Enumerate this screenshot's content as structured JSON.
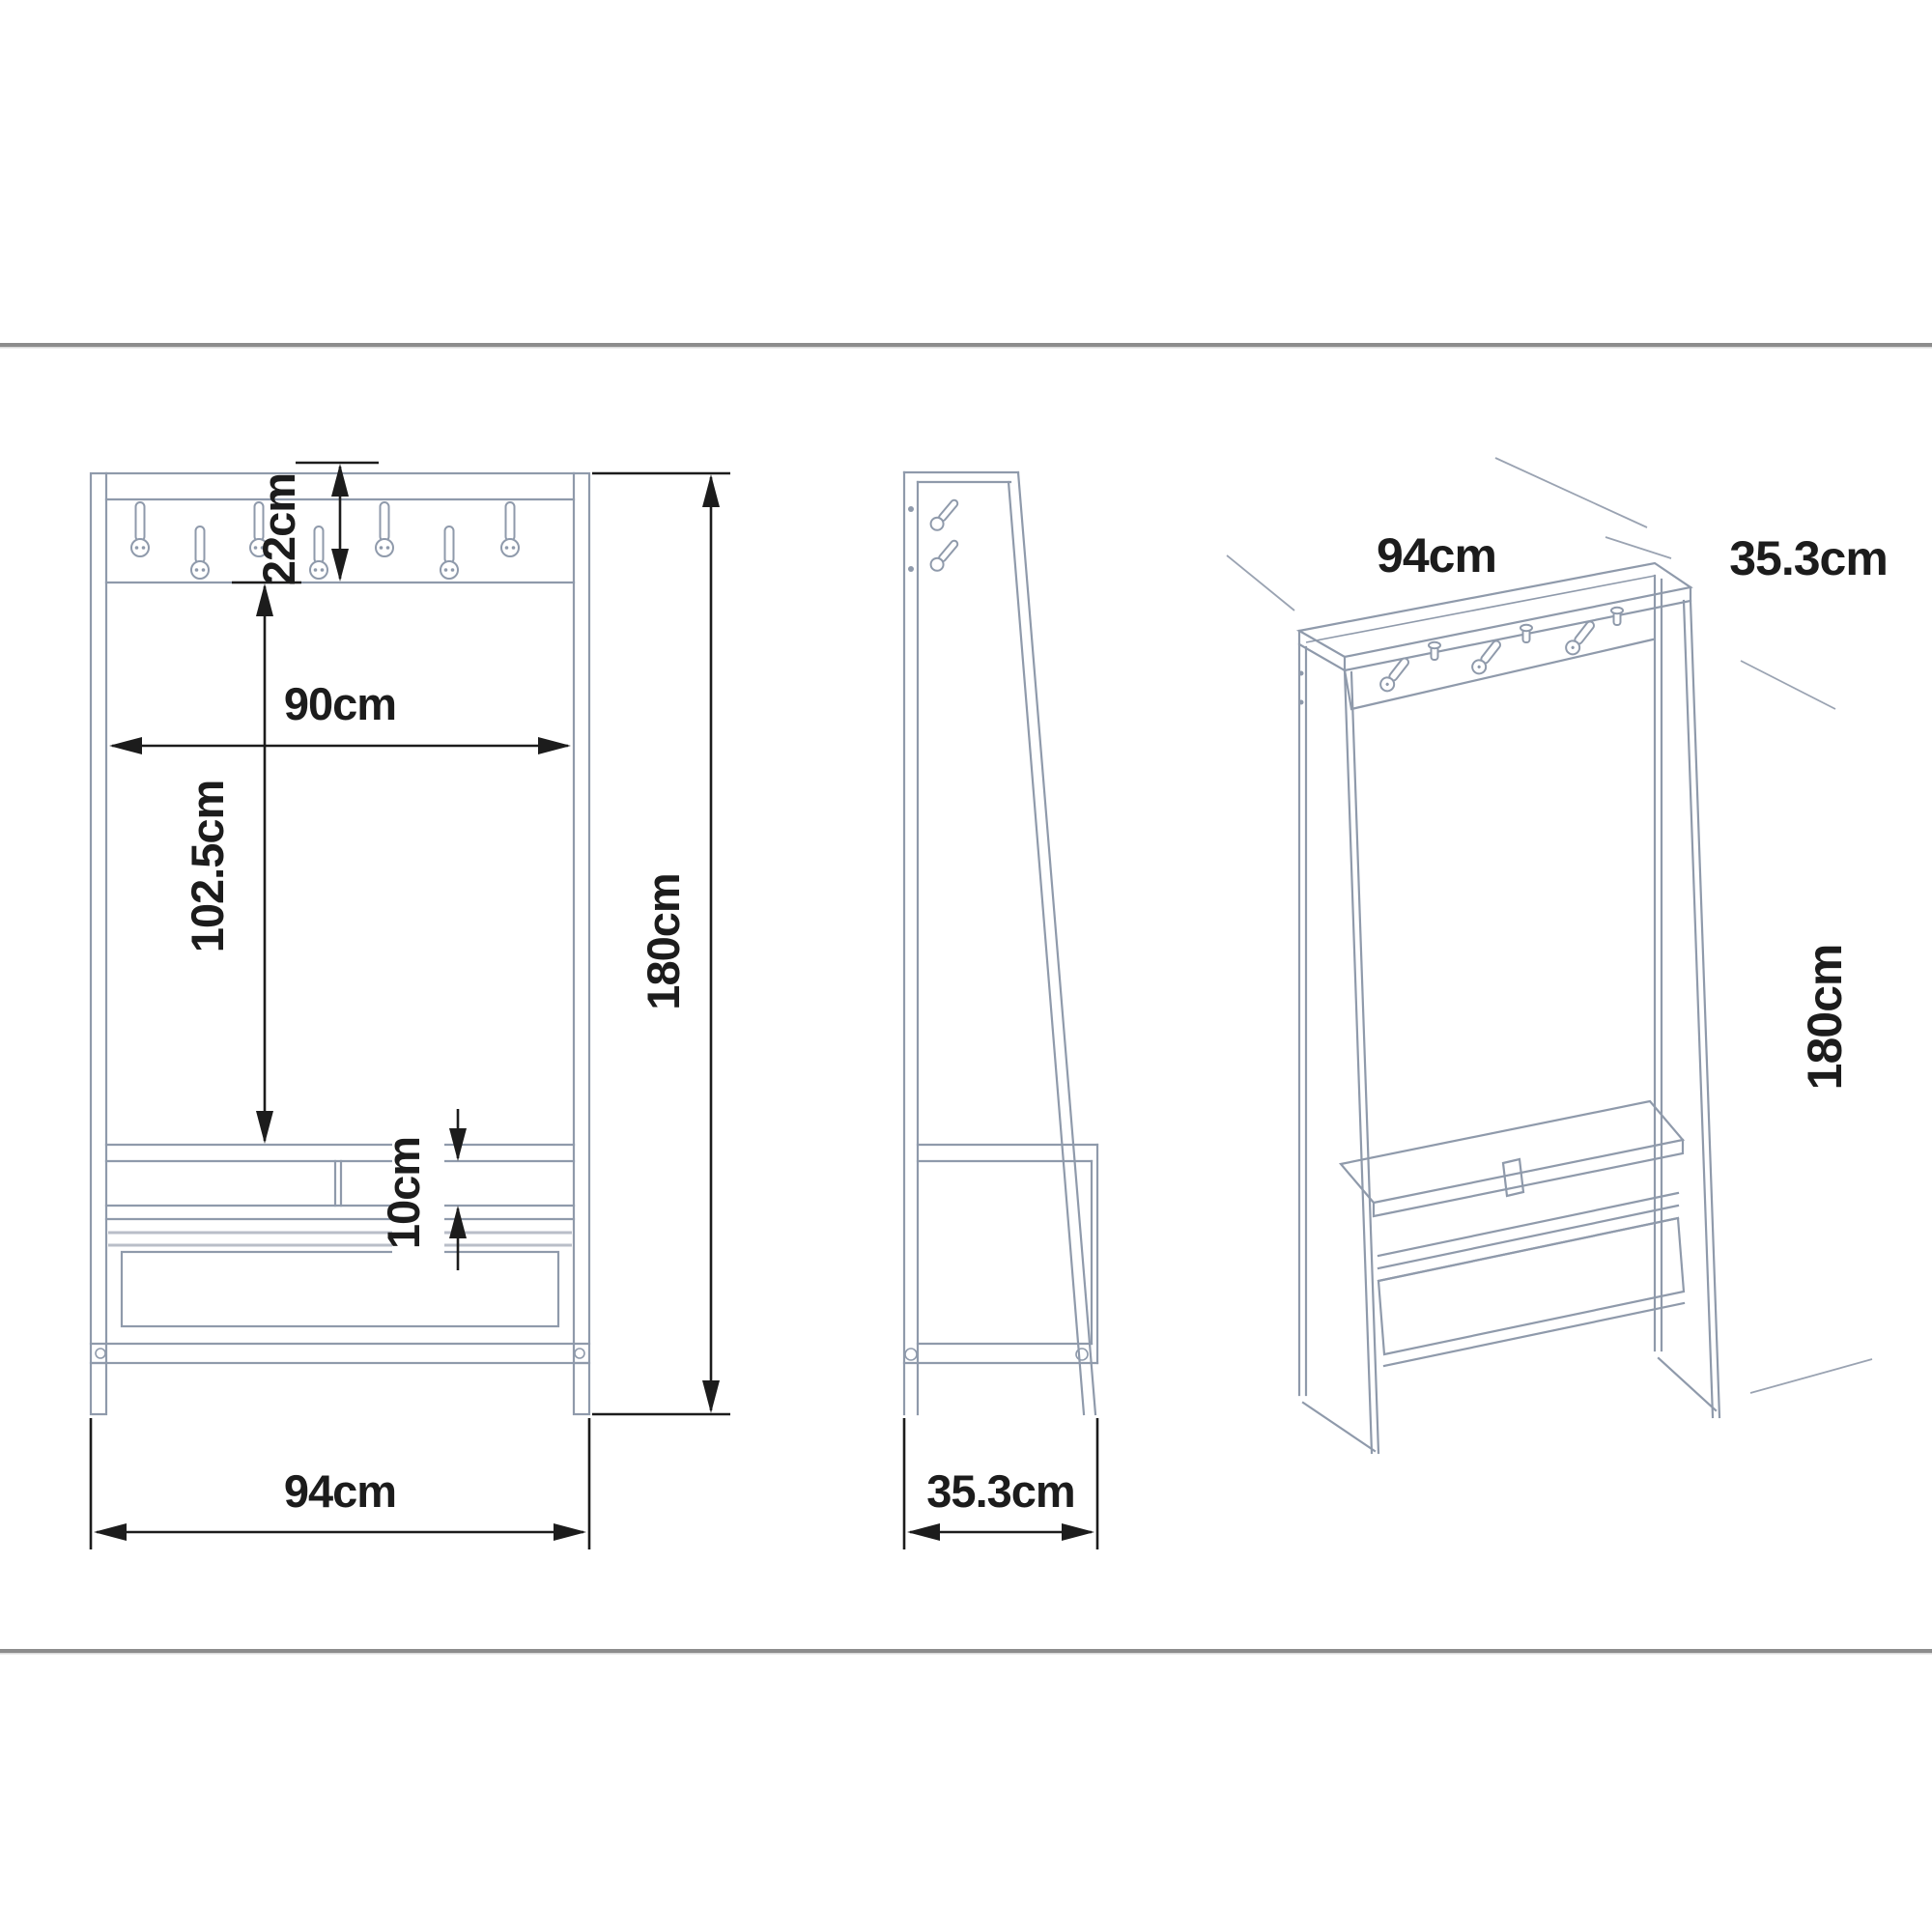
{
  "palette": {
    "furniture_line": "#8f9aab",
    "dimension_color": "#1c1c1c",
    "rule_color": "#8c8c8c",
    "background": "#ffffff"
  },
  "front_view": {
    "hook_panel_height": "22cm",
    "inner_width": "90cm",
    "hook_to_bench_height": "102.5cm",
    "shelf_gap_height": "10cm",
    "total_height": "180cm",
    "total_width": "94cm"
  },
  "side_view": {
    "depth": "35.3cm"
  },
  "iso_view": {
    "width": "94cm",
    "depth": "35.3cm",
    "height": "180cm"
  }
}
